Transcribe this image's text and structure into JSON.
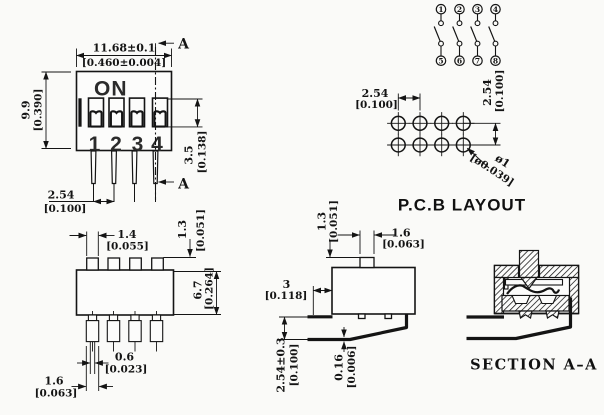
{
  "colors": {
    "background": "#fafaf8",
    "line": "#141414"
  },
  "front_view": {
    "width_mm": "11.68±0.1",
    "width_in": "[0.460±0.004]",
    "height_mm": "9.9",
    "height_in": "[0.390]",
    "slot_mm": "3.5",
    "slot_in": "[0.138]",
    "pitch_mm": "2.54",
    "pitch_in": "[0.100]",
    "on_label": "ON",
    "positions": [
      "1",
      "2",
      "3",
      "4"
    ],
    "section_top": "A",
    "section_bottom": "A"
  },
  "schematic": {
    "top_terminals": [
      "1",
      "2",
      "3",
      "4"
    ],
    "bottom_terminals": [
      "5",
      "6",
      "7",
      "8"
    ]
  },
  "pcb": {
    "title": "P.C.B LAYOUT",
    "pitch_h_mm": "2.54",
    "pitch_h_in": "[0.100]",
    "pitch_v_mm": "2.54",
    "pitch_v_in": "[0.100]",
    "hole_mm": "ø1",
    "hole_in": "[ø0.039]"
  },
  "top_view": {
    "tab_w_mm": "1.4",
    "tab_w_in": "[0.055]",
    "tab_h_mm": "1.3",
    "tab_h_in": "[0.051]",
    "depth_mm": "6.7",
    "depth_in": "[0.264]",
    "wire_mm": "0.6",
    "wire_in": "[0.023]",
    "pin_w_mm": "1.6",
    "pin_w_in": "[0.063]"
  },
  "side_view": {
    "tab_h_mm": "1.3",
    "tab_h_in": "[0.051]",
    "tab_w_mm": "1.6",
    "tab_w_in": "[0.063]",
    "standoff_mm": "3",
    "standoff_in": "[0.118]",
    "row_pitch_mm": "2.54±0.3",
    "row_pitch_in": "[0.100]",
    "lead_mm": "0.16",
    "lead_in": "[0.006]"
  },
  "section_view": {
    "title": "SECTION  A–A"
  }
}
